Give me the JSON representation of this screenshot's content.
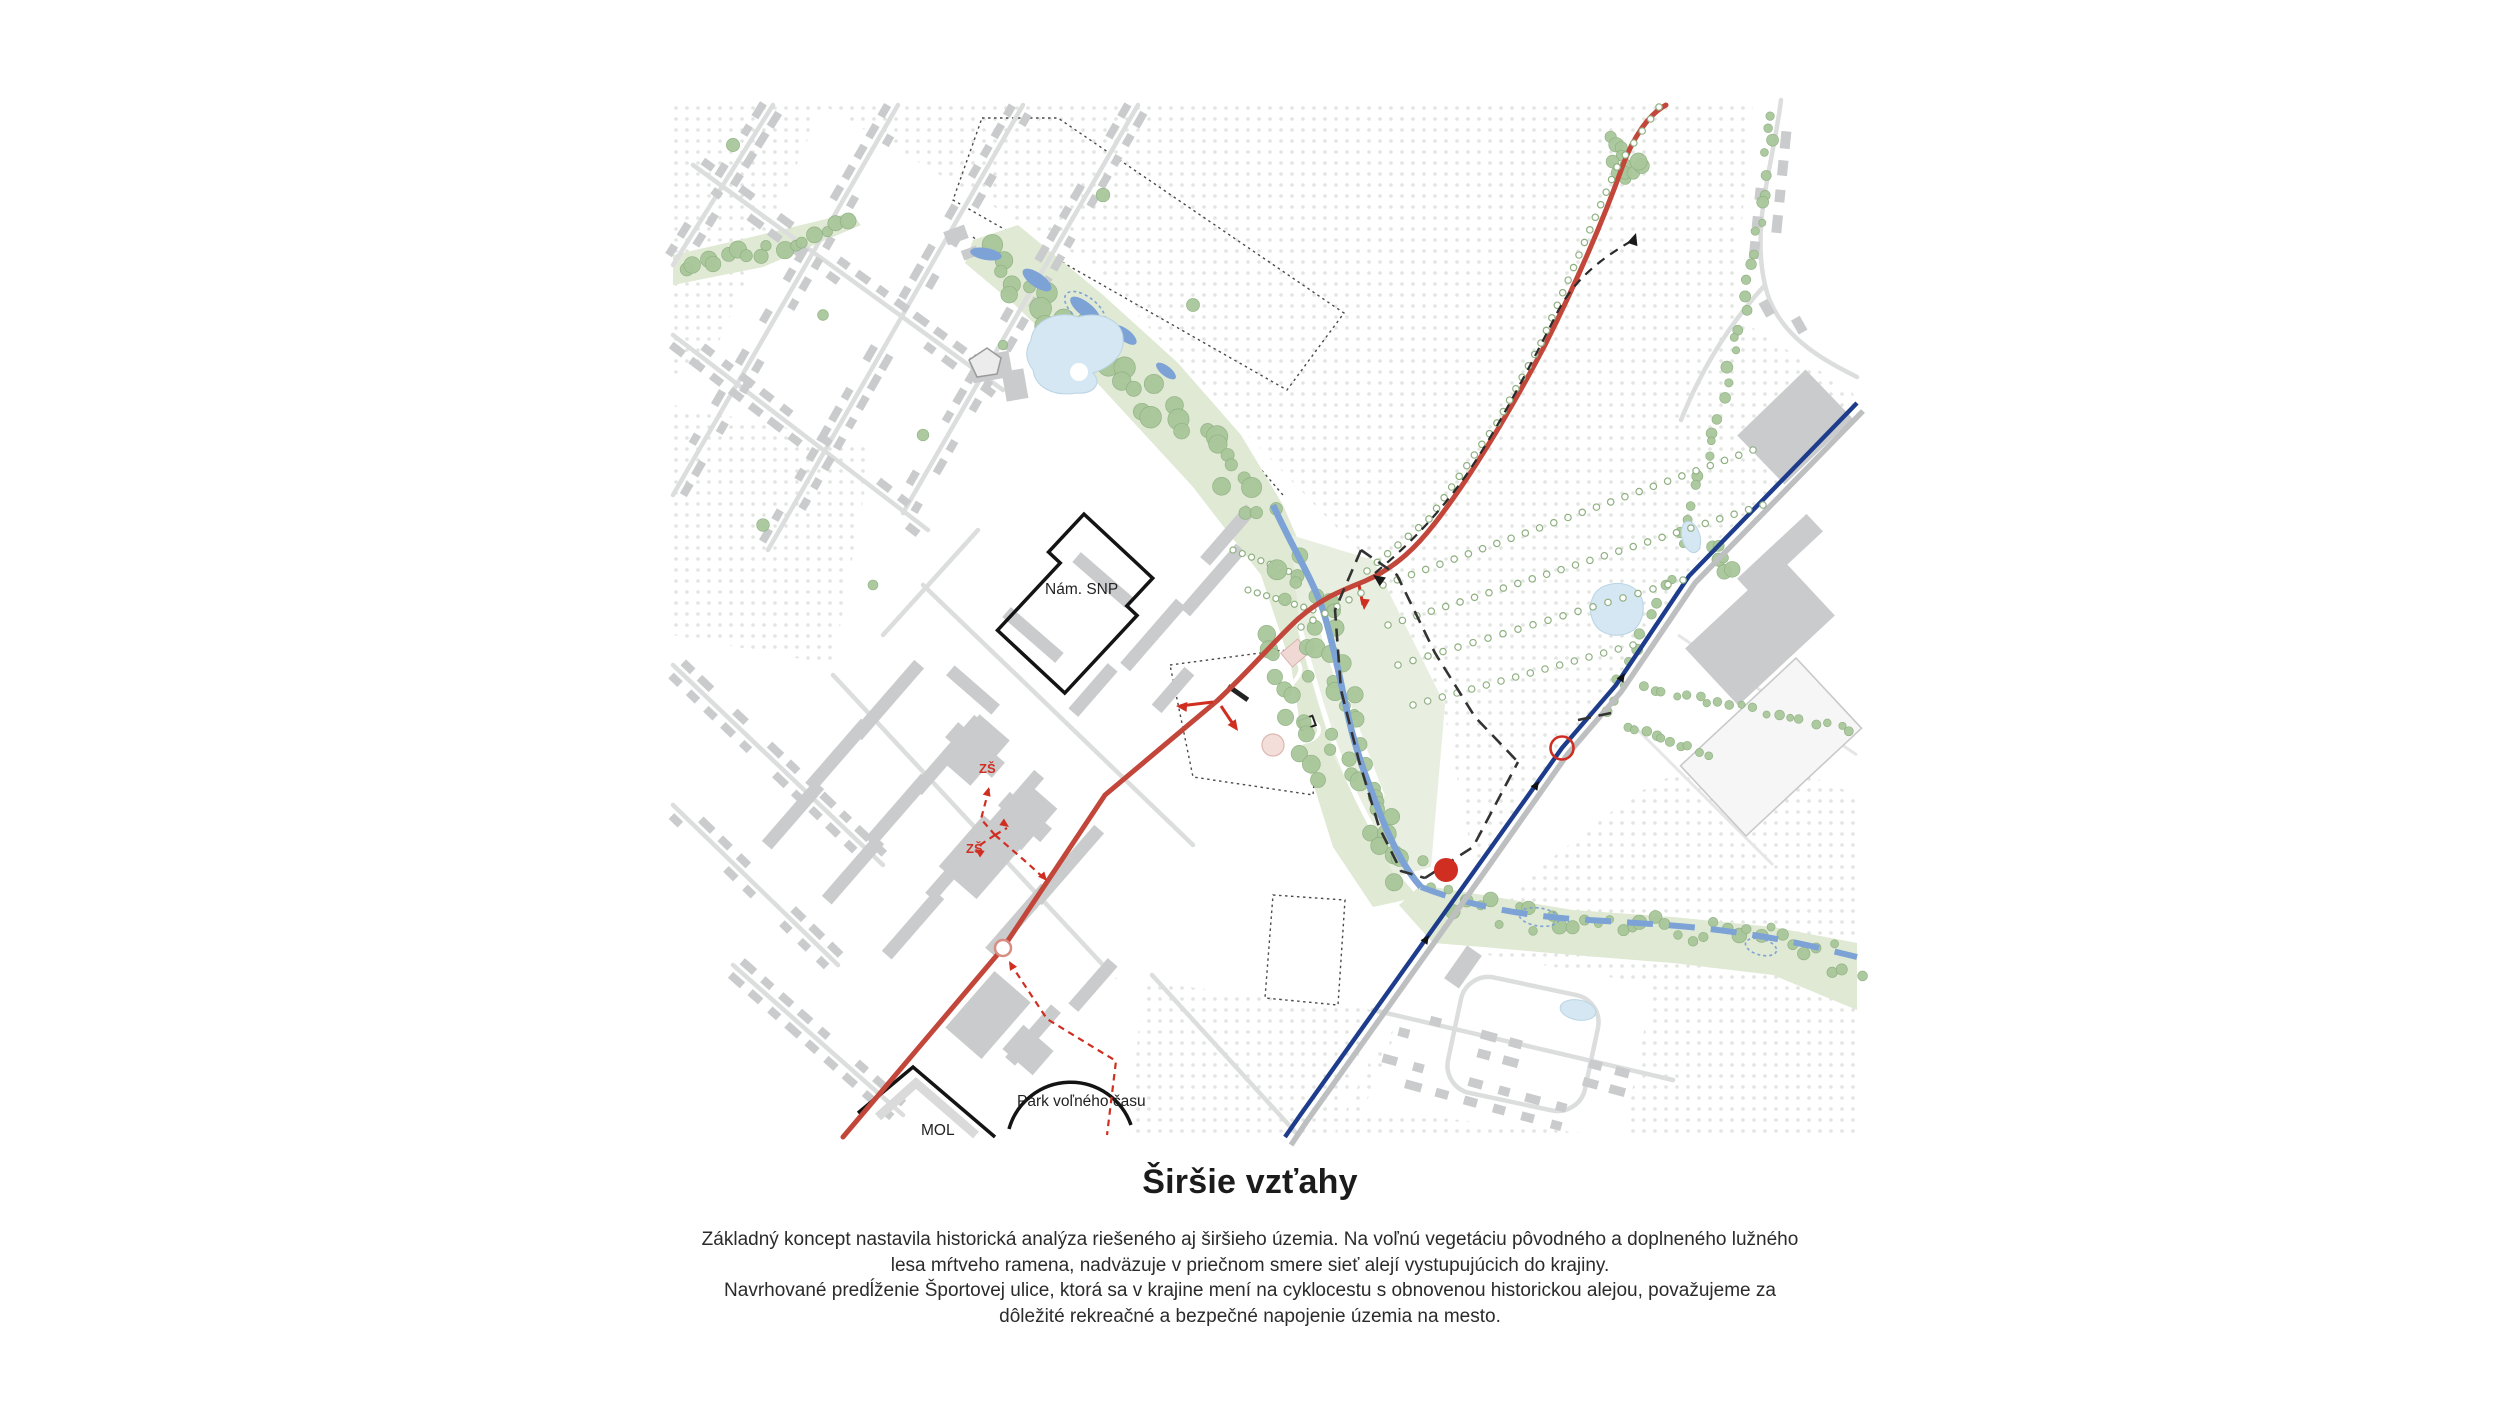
{
  "title": "Širšie vzťahy",
  "caption": {
    "line1": "Základný koncept nastavila historická analýza riešeného aj širšieho územia. Na voľnú vegetáciu pôvodného a doplneného lužného",
    "line2": "lesa mŕtveho ramena, nadväzuje v priečnom smere sieť alejí vystupujúcich do krajiny.",
    "line3": "Navrhované predĺženie Športovej ulice, ktorá sa v krajine mení na cyklocestu s obnovenou historickou alejou, považujeme za",
    "line4": "dôležité rekreačné a bezpečné napojenie územia na mesto."
  },
  "map": {
    "labels": {
      "square": "Nám. SNP",
      "school1": "ZŠ",
      "school2": "ZŠ",
      "park": "Park voľného času",
      "gas_station": "MOL"
    },
    "colors": {
      "road_red": "#c2463a",
      "accent_red": "#cf2e21",
      "rail_navy": "#1e3c8c",
      "rail_gray": "#bdbfc1",
      "water_blue": "#7da2d6",
      "pond_blue": "#d4e7f2",
      "tree_green": "#a9c79b",
      "tree_stroke": "#8fb081",
      "corridor_green": "#dfe9d3",
      "site_green": "#e8efe0",
      "building_gray": "#c9cbcc",
      "street_gray": "#dcdddd",
      "dots": "#e2e5e1",
      "boundary_black": "#333333",
      "label_black": "#222222"
    }
  }
}
